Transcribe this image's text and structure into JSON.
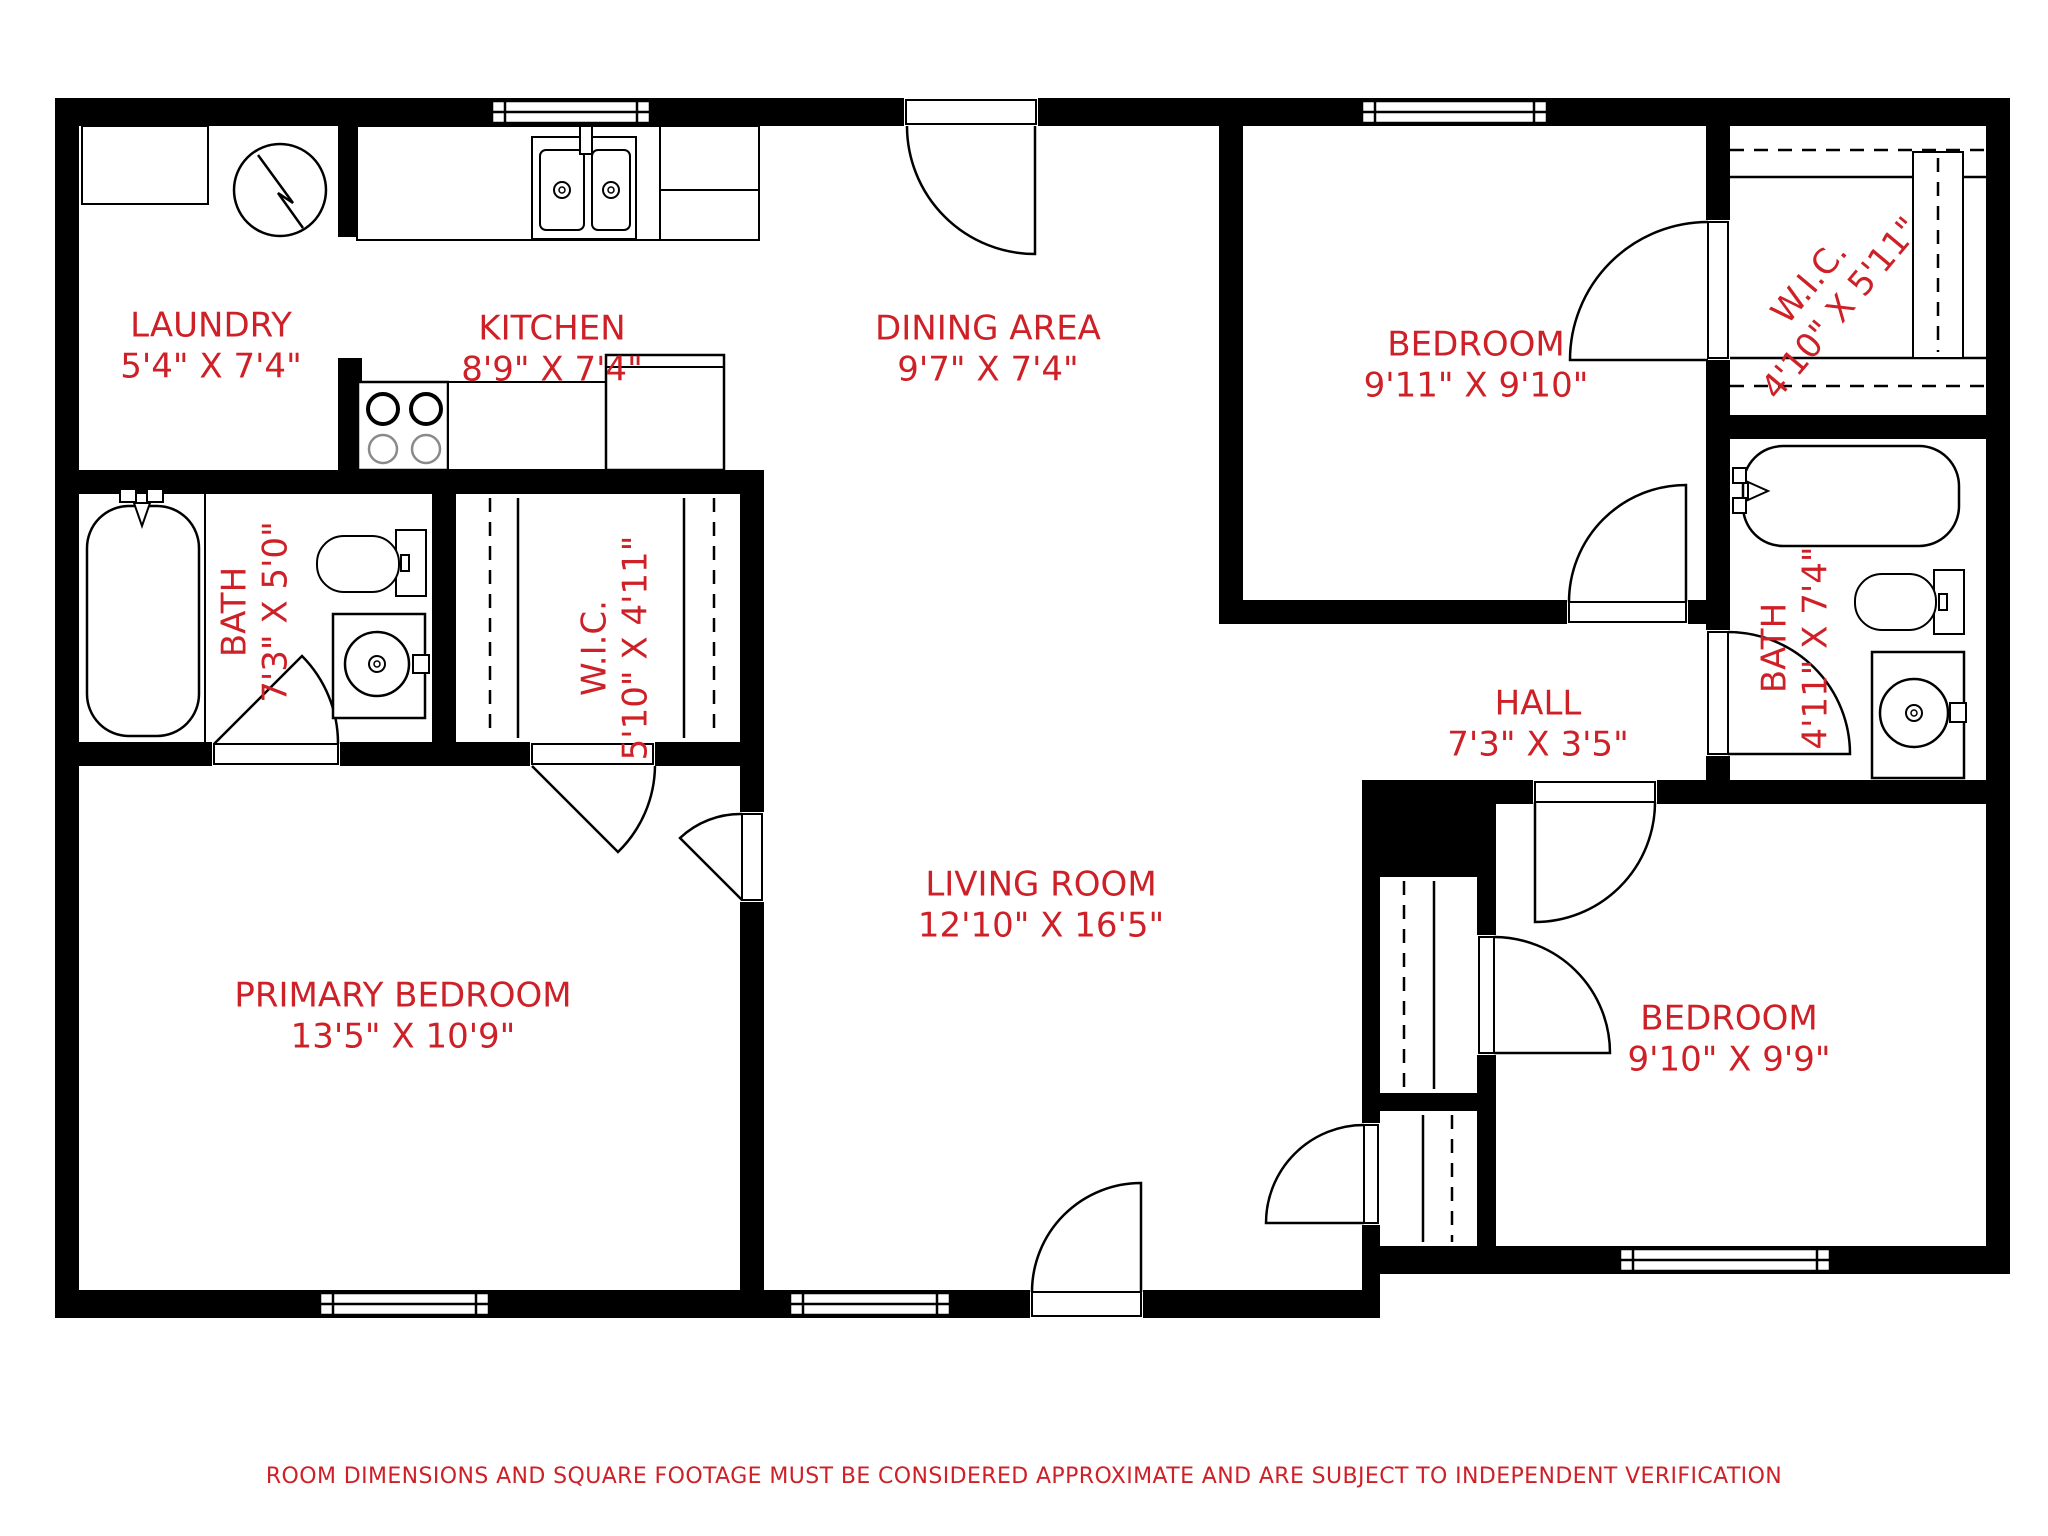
{
  "colors": {
    "label_red": "#ce2027",
    "wall_black": "#000000"
  },
  "disclaimer": "ROOM DIMENSIONS AND SQUARE FOOTAGE MUST BE CONSIDERED APPROXIMATE AND ARE SUBJECT TO INDEPENDENT VERIFICATION",
  "rooms": [
    {
      "id": "laundry",
      "name": "LAUNDRY",
      "dims": "5'4\" X 7'4\""
    },
    {
      "id": "kitchen",
      "name": "KITCHEN",
      "dims": "8'9\" X 7'4\""
    },
    {
      "id": "dining-area",
      "name": "DINING AREA",
      "dims": "9'7\" X 7'4\""
    },
    {
      "id": "bedroom-top-right",
      "name": "BEDROOM",
      "dims": "9'11\" X 9'10\""
    },
    {
      "id": "wic-top-right",
      "name": "W.I.C.",
      "dims": "4'10\" X 5'11\""
    },
    {
      "id": "bath-left",
      "name": "BATH",
      "dims": "7'3\" X 5'0\""
    },
    {
      "id": "wic-left",
      "name": "W.I.C.",
      "dims": "5'10\" X 4'11\""
    },
    {
      "id": "hall",
      "name": "HALL",
      "dims": "7'3\" X 3'5\""
    },
    {
      "id": "bath-right",
      "name": "BATH",
      "dims": "4'11\" X 7'4\""
    },
    {
      "id": "living-room",
      "name": "LIVING ROOM",
      "dims": "12'10\" X 16'5\""
    },
    {
      "id": "primary-bedroom",
      "name": "PRIMARY BEDROOM",
      "dims": "13'5\" X 10'9\""
    },
    {
      "id": "bedroom-bottom-right",
      "name": "BEDROOM",
      "dims": "9'10\" X 9'9\""
    }
  ],
  "fixtures": [
    "washing-machine",
    "laundry-counter",
    "kitchen-sink",
    "kitchen-counter",
    "range-stove",
    "refrigerator",
    "bathtub",
    "toilet",
    "vanity-sink",
    "closet-rod-dashed",
    "closet-shelf",
    "entry-door",
    "interior-doors",
    "windows"
  ]
}
